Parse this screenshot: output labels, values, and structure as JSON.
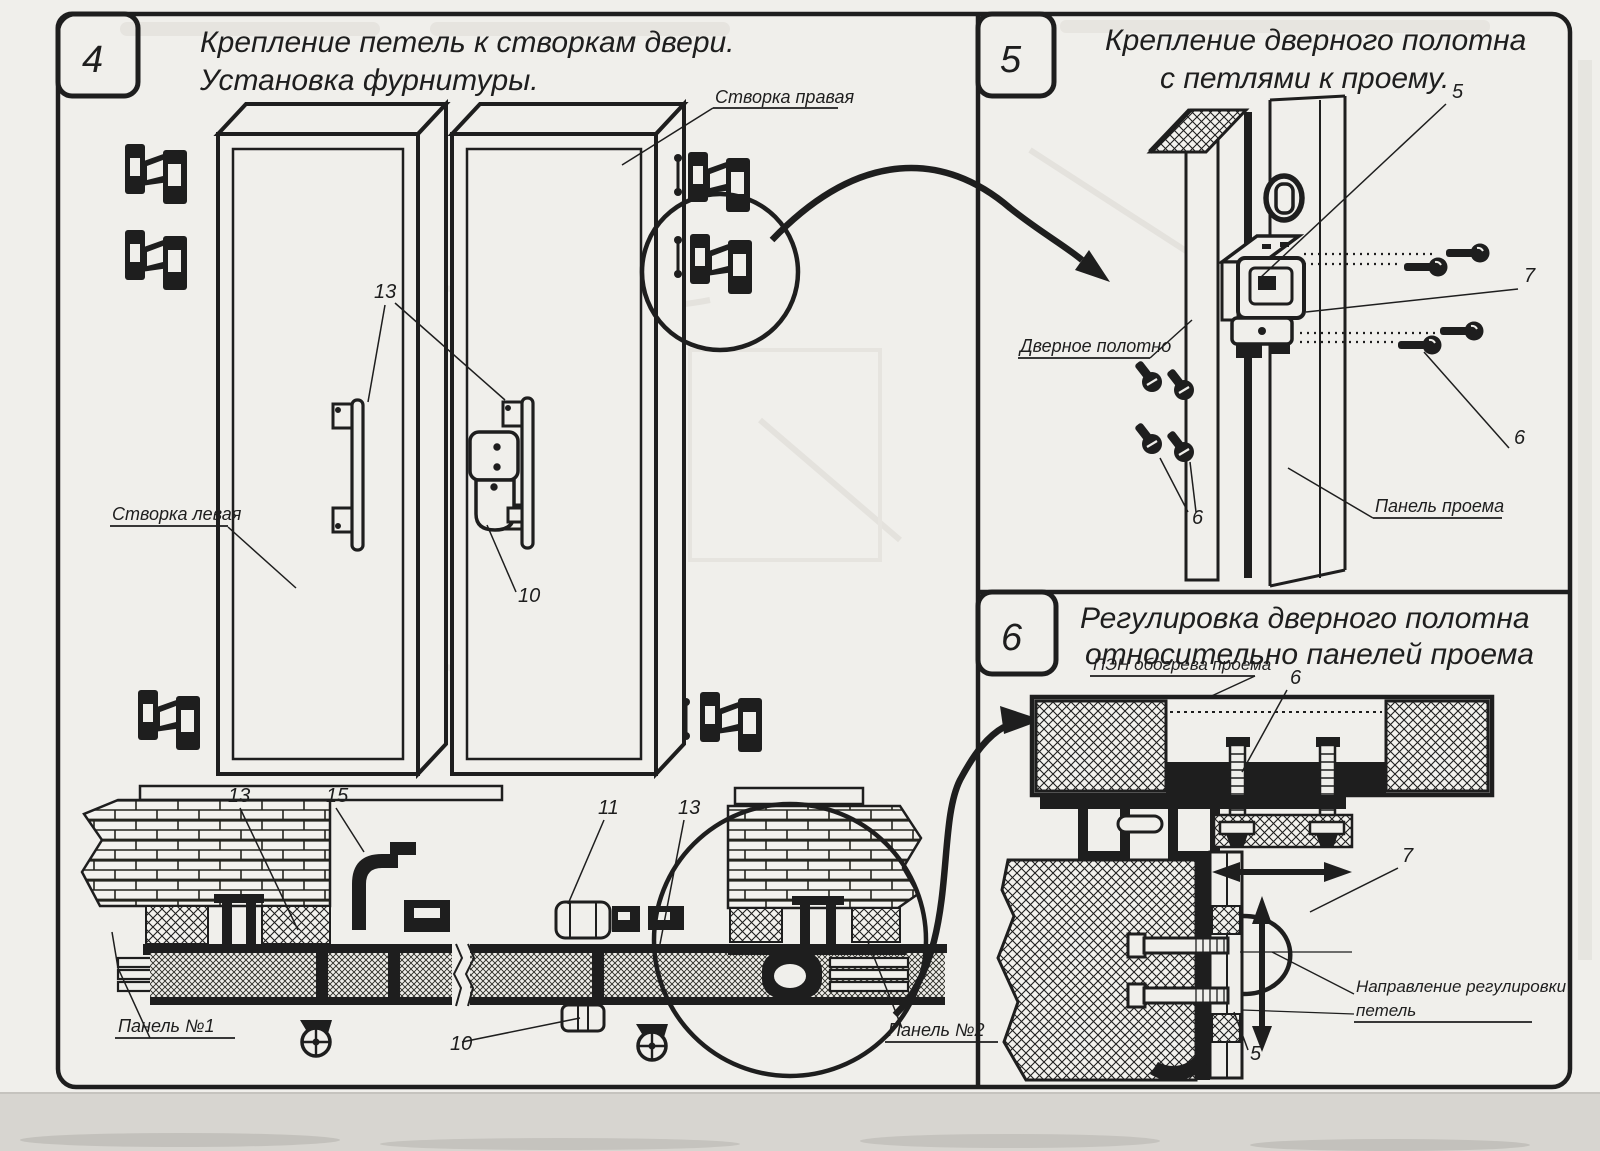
{
  "panels": {
    "p4": {
      "number": "4",
      "title1": "Крепление петель к створкам двери.",
      "title2": "Установка фурнитуры.",
      "label_right_leaf": "Створка правая",
      "label_left_leaf": "Створка левая",
      "label_panel1": "Панель №1",
      "label_panel2": "Панель №2",
      "callout_handle_13": "13",
      "callout_lock_10": "10",
      "callout_section_13_left": "13",
      "callout_bracket_15": "15",
      "callout_profile_11": "11",
      "callout_section_13_right": "13",
      "callout_roller_10": "10"
    },
    "p5": {
      "number": "5",
      "title1": "Крепление дверного полотна",
      "title2": "с петлями к проему.",
      "label_door_leaf": "Дверное полотно",
      "label_opening_panel": "Панель проема",
      "callout_5": "5",
      "callout_7": "7",
      "callout_6_right": "6",
      "callout_6_bottom": "6"
    },
    "p6": {
      "number": "6",
      "title1": "Регулировка дверного полотна",
      "title2": "относительно панелей проема",
      "label_heater": "ПЭН обогрева проема",
      "label_direction1": "Направление регулировки",
      "label_direction2": "петель",
      "callout_6": "6",
      "callout_7": "7",
      "callout_5": "5"
    }
  },
  "colors": {
    "ink": "#1e1e1e",
    "paper": "#f0efeb",
    "scan_band": "#d7d5d0"
  }
}
